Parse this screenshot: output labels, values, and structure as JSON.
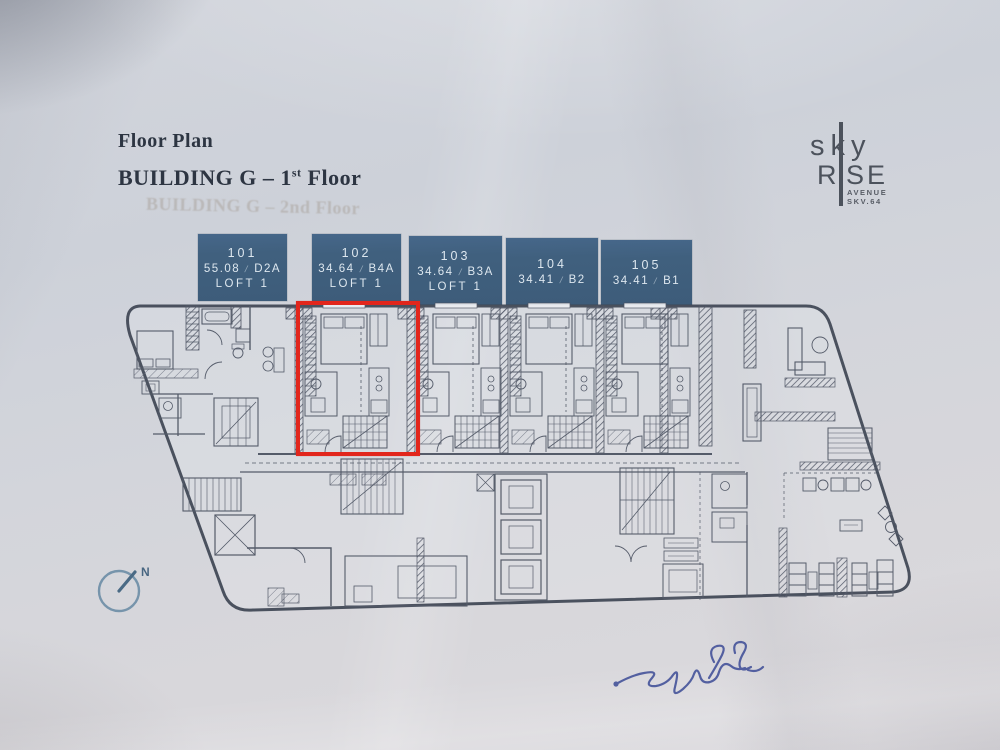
{
  "document": {
    "title": "Floor Plan",
    "subtitle_main": "BUILDING G – 1",
    "subtitle_sup": "st",
    "subtitle_tail": " Floor",
    "show_through_text": "BUILDING G – 2nd Floor"
  },
  "logo": {
    "word_sky": "sky",
    "word_rise_left": "R",
    "word_rise_right": "SE",
    "sub_line1": "AVENUE",
    "sub_line2": "SKV.64"
  },
  "unit_labels": {
    "separator": "/",
    "units": [
      {
        "number": "101",
        "area": "55.08",
        "type": "D2A",
        "loft": "LOFT 1"
      },
      {
        "number": "102",
        "area": "34.64",
        "type": "B4A",
        "loft": "LOFT 1"
      },
      {
        "number": "103",
        "area": "34.64",
        "type": "B3A",
        "loft": "LOFT 1"
      },
      {
        "number": "104",
        "area": "34.41",
        "type": "B2"
      },
      {
        "number": "105",
        "area": "34.41",
        "type": "B1"
      }
    ]
  },
  "highlight": {
    "unit": "102",
    "color": "#e2261c"
  },
  "compass": {
    "north_label": "N"
  },
  "colors": {
    "paper": "#d3d5db",
    "ink_title": "#2d3542",
    "logo_gray": "#4c525c",
    "box_blue": "#40607e",
    "box_text": "#dde7ef",
    "plan_line": "#49505e",
    "highlight_red": "#e2261c",
    "compass_blue": "#5d7f99",
    "signature_ink": "#3c4b96"
  }
}
